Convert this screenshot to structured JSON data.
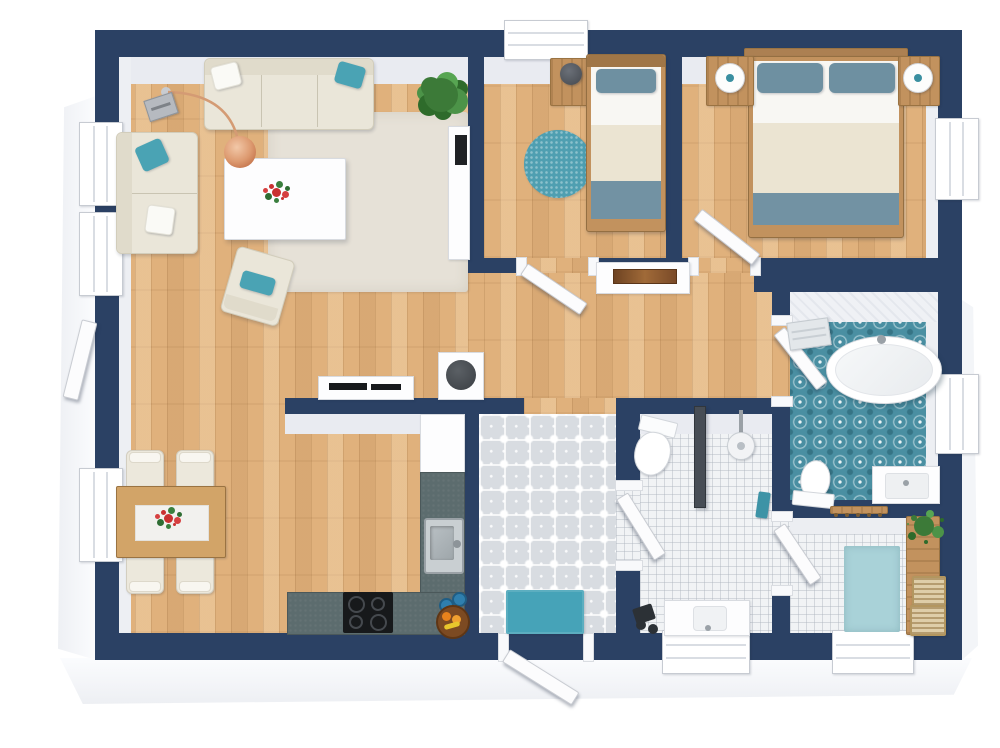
{
  "meta": {
    "type": "3d-floor-plan",
    "view": "top-down",
    "text_visible": "none"
  },
  "palette": {
    "wall": "#2b4164",
    "wood": "#e0b17c",
    "furniture_wood": "#c2925e",
    "counter": "#5c6c6e",
    "teal": "#4aa3b4",
    "teal_rug": "#4f9fb1",
    "teal_light": "#a9d2d8",
    "bath_tile": "#4a8fa2",
    "entry_tile": "#d8dce1",
    "white_tile": "#f1f3f5",
    "sofa": "#eae6d9",
    "area_rug": "#e6e1d7",
    "duvet": "#ebe4d2",
    "blanket": "#7292a3",
    "pillow": "#6e90a1",
    "mat": "#46a3b8",
    "door_leaf": "#fcfcfd"
  },
  "rooms": [
    {
      "name": "living-room",
      "floor": "wood",
      "items": [
        "sofa",
        "loveseat",
        "coffee-table",
        "flower-centerpiece",
        "area-rug",
        "arc-floor-lamp",
        "speaker",
        "armchair",
        "potted-plant",
        "tv-sideboard",
        "media-console",
        "round-top-appliance"
      ]
    },
    {
      "name": "dining-area",
      "floor": "wood",
      "items": [
        "dining-table",
        "table-runner",
        "flower-centerpiece"
      ],
      "chairs": 4
    },
    {
      "name": "kitchen",
      "floor": "wood",
      "items": [
        "l-shaped-counter",
        "sink",
        "faucet",
        "cooktop",
        "tall-cabinet",
        "fruit-bowl",
        "jars"
      ]
    },
    {
      "name": "entry-hall",
      "floor": "patterned-tile",
      "items": [
        "doormat",
        "front-door"
      ]
    },
    {
      "name": "hallway",
      "floor": "wood",
      "items": [
        "console-table",
        "artwork-tray"
      ]
    },
    {
      "name": "small-bedroom",
      "floor": "wood",
      "items": [
        "single-bed",
        "nightstand",
        "table-lamp",
        "round-rug"
      ],
      "windows": 1
    },
    {
      "name": "master-bedroom",
      "floor": "wood",
      "items": [
        "double-bed",
        "nightstand-left",
        "nightstand-right",
        "table-lamp-left",
        "table-lamp-right"
      ],
      "windows": 1
    },
    {
      "name": "bathroom",
      "floor": "teal-pattern-tile",
      "items": [
        "freestanding-bathtub",
        "toilet",
        "vanity-sink",
        "towel-rail"
      ],
      "windows": 1
    },
    {
      "name": "shower-room",
      "floor": "white-tile",
      "items": [
        "toilet",
        "shower-head",
        "glass-partition",
        "vanity-sink",
        "bathroom-scale",
        "hand-towel"
      ],
      "windows": 1
    },
    {
      "name": "utility-room",
      "floor": "white-tile",
      "items": [
        "rug",
        "wooden-bench",
        "storage-basket",
        "storage-basket",
        "potted-plant",
        "wall-hooks"
      ],
      "windows": 1
    }
  ],
  "doors": [
    "front-door",
    "small-bedroom-door",
    "master-bedroom-door",
    "bathroom-door",
    "shower-room-door",
    "utility-room-door",
    "side-casement"
  ]
}
